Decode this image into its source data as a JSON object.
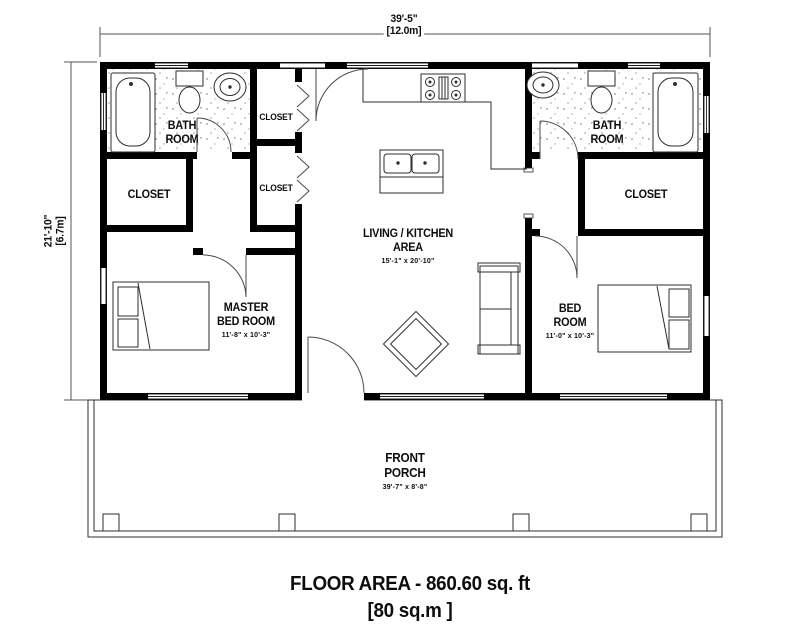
{
  "plan": {
    "type": "residential-floor-plan",
    "overall_width": {
      "imperial": "39'-5\"",
      "metric": "[12.0m]"
    },
    "overall_depth": {
      "imperial": "21'-10\"",
      "metric": "[6.7m]"
    }
  },
  "rooms": {
    "bath_left": {
      "line1": "BATH",
      "line2": "ROOM"
    },
    "closet_left": {
      "label": "CLOSET"
    },
    "closet_hall_top": {
      "label": "CLOSET"
    },
    "closet_hall_bottom": {
      "label": "CLOSET"
    },
    "living_kitchen": {
      "line1": "LIVING / KITCHEN",
      "line2": "AREA",
      "size": "15'-1\" x 20'-10\""
    },
    "master_bedroom": {
      "line1": "MASTER",
      "line2": "BED ROOM",
      "size": "11'-8\" x 10'-3\""
    },
    "bedroom": {
      "line1": "BED",
      "line2": "ROOM",
      "size": "11'-0\" x 10'-3\""
    },
    "bath_right": {
      "line1": "BATH",
      "line2": "ROOM"
    },
    "closet_right": {
      "label": "CLOSET"
    },
    "front_porch": {
      "line1": "FRONT",
      "line2": "PORCH",
      "size": "39'-7\" x 8'-8\""
    }
  },
  "title": {
    "line1": "FLOOR AREA - 860.60 sq. ft",
    "line2": "[80 sq.m ]"
  },
  "colors": {
    "wall": "#000000",
    "line": "#2e2e2e",
    "background": "#ffffff"
  }
}
